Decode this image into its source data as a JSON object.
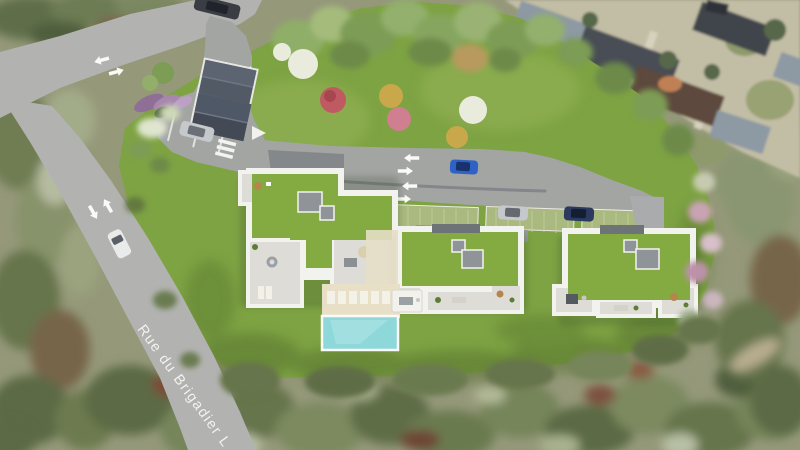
{
  "scene": {
    "street_label": "Rue du Brigadier L"
  },
  "colors": {
    "lawn": "#7ea343",
    "roofGreen": "#84aa42",
    "roadPublic": "#b2b3b0",
    "roadCourt": "#a3a5a3",
    "roadRamp": "#85888b",
    "parapetWhite": "#f2f2ef",
    "terraceFloor": "#dedcd6",
    "skylightGray": "#8f9499",
    "poolWater": "#8ed8da",
    "poolDeck": "#e7dfc6",
    "paverGreen": "#a9b97f",
    "markingWhite": "#fafaf8",
    "labelWhite": "#f6f6f3",
    "carBlue": "#2f62c4",
    "carSilver": "#c6c9cc",
    "carNavy": "#2b3a5e",
    "carDark": "#3a3e44",
    "carWhite": "#e9eaea",
    "photoBase": "#95997a",
    "neighborhoodGround": "#c2bda5",
    "roofSlate": "#8d99a3",
    "roofDarkSlate": "#4a4e55",
    "roofBrown": "#5d4a3d",
    "treeWhite": "#e9ecdd",
    "treePink": "#c05a62",
    "treePinkLight": "#cf7f90",
    "treeYellow": "#c9a84c",
    "shrubPurple": "#a886ae",
    "loungerWhite": "#f3f1e8"
  }
}
